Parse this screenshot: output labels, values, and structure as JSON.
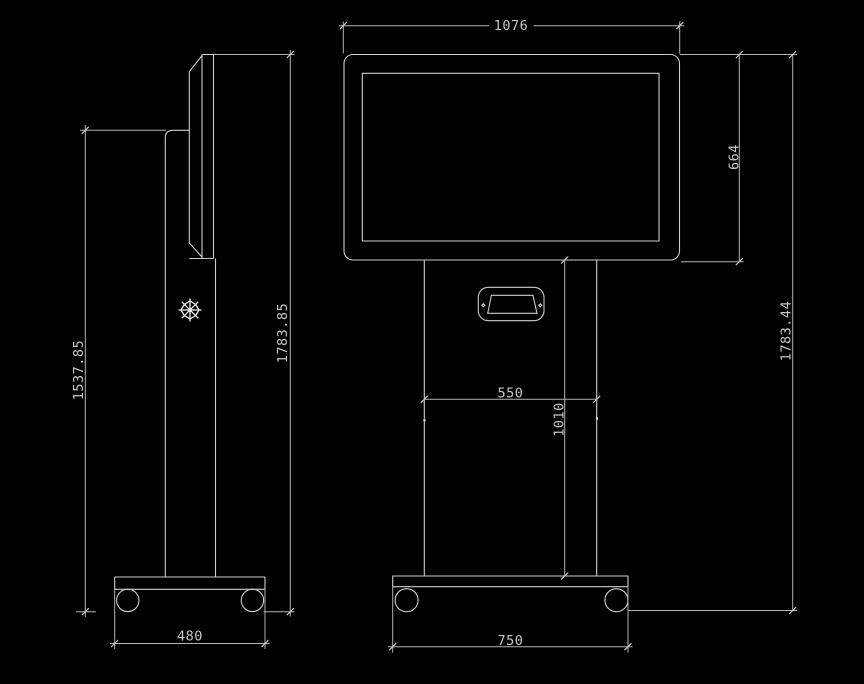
{
  "meta": {
    "drawing_type": "kiosk technical dimension drawing",
    "units": "mm",
    "views": [
      "side view",
      "front view"
    ]
  },
  "side_view": {
    "dim_column_height": "1537.85",
    "dim_total_height": "1783.85",
    "dim_base_depth": "480"
  },
  "front_view": {
    "dim_display_width": "1076",
    "dim_display_height": "664",
    "dim_total_height": "1783.44",
    "dim_pedestal_width": "550",
    "dim_pedestal_height": "1010",
    "dim_base_width": "750"
  },
  "icons": {
    "point_marker_icon": "eight-spoke snowflake asterisk"
  },
  "colors": {
    "background": "#000000",
    "object_line": "#cdcdcd",
    "dimension_line": "#b4b4b4",
    "text": "#c6c6c6"
  }
}
